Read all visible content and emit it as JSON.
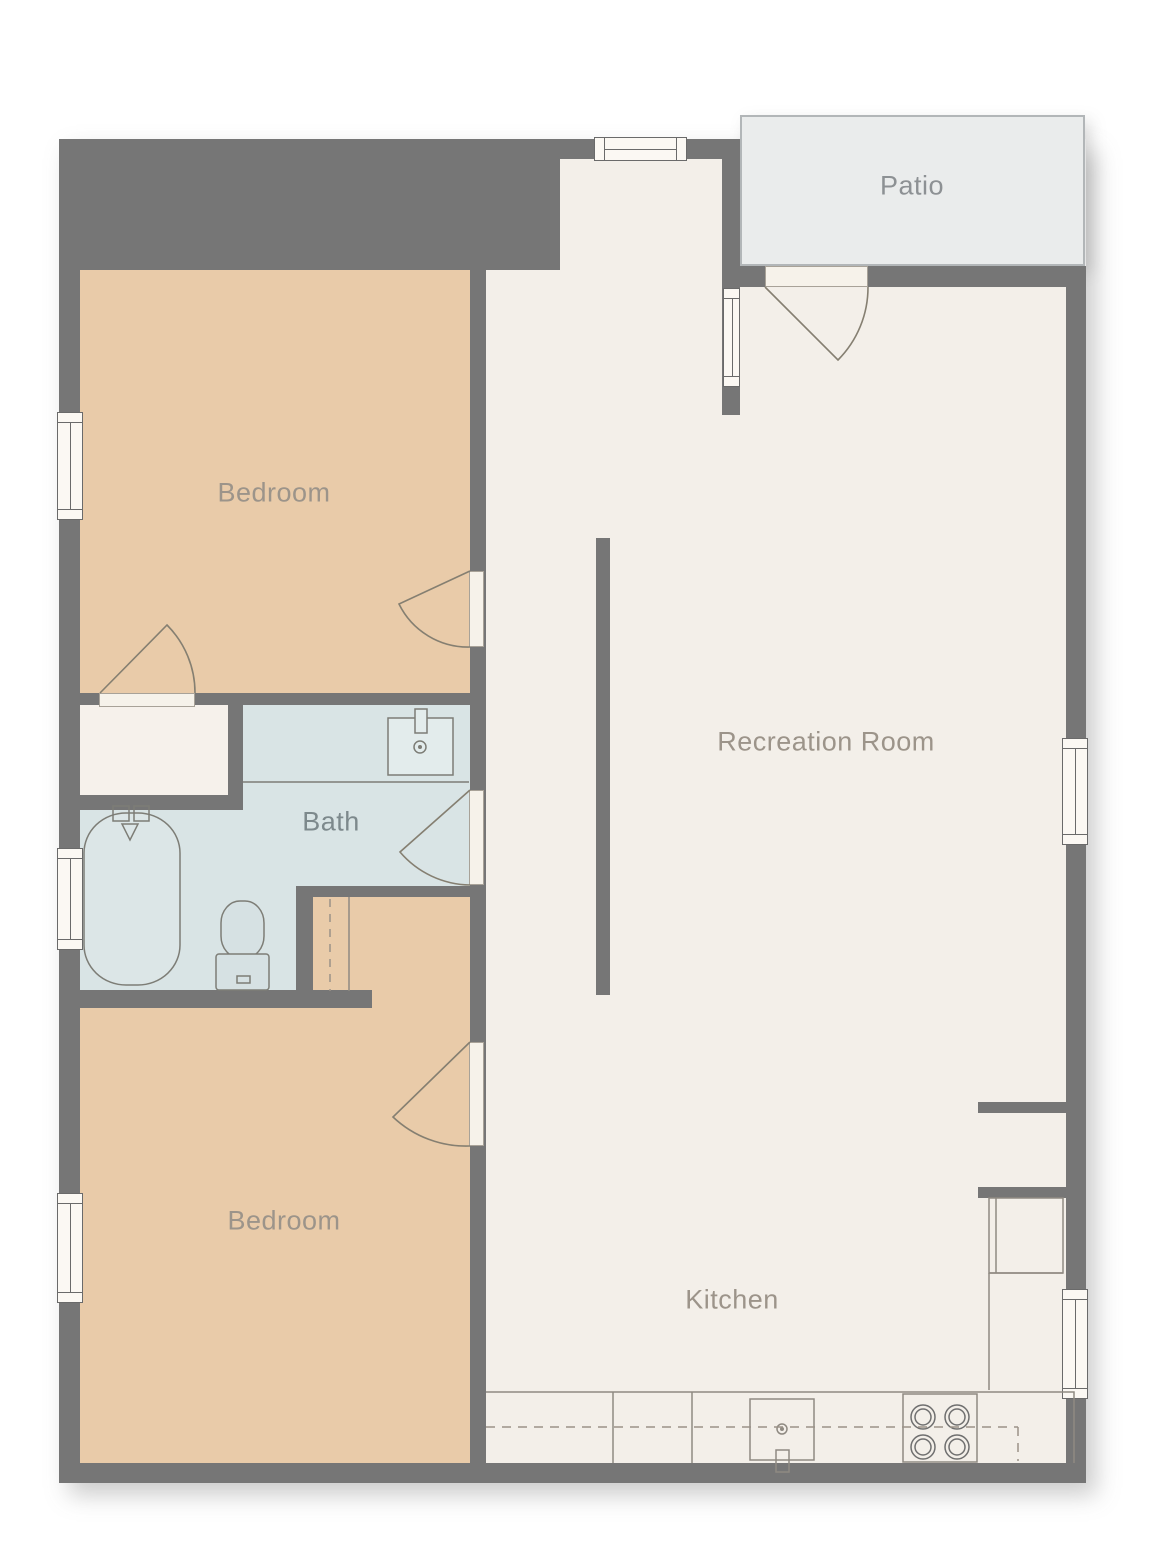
{
  "rooms": {
    "bedroom_top": {
      "label": "Bedroom"
    },
    "recreation": {
      "label": "Recreation Room"
    },
    "bath": {
      "label": "Bath"
    },
    "bedroom_bottom": {
      "label": "Bedroom"
    },
    "kitchen": {
      "label": "Kitchen"
    },
    "patio": {
      "label": "Patio"
    }
  },
  "colors": {
    "wall": "#767676",
    "bedroom_fill": "#e9cba9",
    "bath_fill": "#d9e4e5",
    "living_fill": "#f3efe9",
    "closet_fill": "#f6f1eb",
    "patio_fill": "#eaecec",
    "patio_border": "#b2b6b8",
    "window_fill": "#fbf8f3",
    "window_frame": "#6a6a6a",
    "door_leaf": "#f6f2ea",
    "fixture_line": "#847f77",
    "label_warm": "#9c948a",
    "label_bath": "#7d898c",
    "label_patio": "#8d9194"
  }
}
